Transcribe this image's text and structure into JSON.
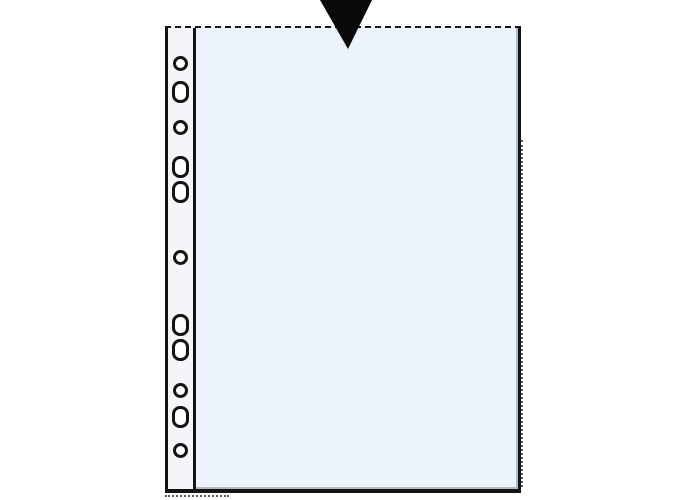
{
  "illustration": {
    "label": "punched-pocket-top-opening-diagram",
    "colors": {
      "outline": "#141414",
      "pocket_fill": "#edf3fa",
      "strip_fill": "#f3f5f9",
      "hole_fill": "#ffffff",
      "arrow_fill": "#0a0a0a",
      "shade": "#8f99a4",
      "page_bg": "#ffffff"
    },
    "pocket": {
      "left": 165,
      "top": 26,
      "width": 356,
      "height": 467,
      "strip_inner_line_x": 196,
      "top_edge_style": "dashed-open",
      "side_edge_style": "solid-welded"
    },
    "arrow": {
      "icon": "down-arrow-icon",
      "points": "320,0 372,0 348,49"
    },
    "holes": [
      {
        "shape": "round",
        "cx": 180,
        "cy": 63,
        "w": 15,
        "h": 15
      },
      {
        "shape": "oblong",
        "cx": 180,
        "cy": 92,
        "w": 17,
        "h": 22
      },
      {
        "shape": "round",
        "cx": 180,
        "cy": 127,
        "w": 15,
        "h": 15
      },
      {
        "shape": "oblong",
        "cx": 180,
        "cy": 167,
        "w": 17,
        "h": 22
      },
      {
        "shape": "oblong",
        "cx": 180,
        "cy": 192,
        "w": 17,
        "h": 22
      },
      {
        "shape": "round",
        "cx": 180,
        "cy": 257,
        "w": 15,
        "h": 15
      },
      {
        "shape": "oblong",
        "cx": 180,
        "cy": 325,
        "w": 17,
        "h": 22
      },
      {
        "shape": "oblong",
        "cx": 180,
        "cy": 350,
        "w": 17,
        "h": 22
      },
      {
        "shape": "round",
        "cx": 180,
        "cy": 390,
        "w": 15,
        "h": 15
      },
      {
        "shape": "oblong",
        "cx": 180,
        "cy": 417,
        "w": 17,
        "h": 22
      },
      {
        "shape": "round",
        "cx": 180,
        "cy": 450,
        "w": 15,
        "h": 15
      }
    ]
  }
}
